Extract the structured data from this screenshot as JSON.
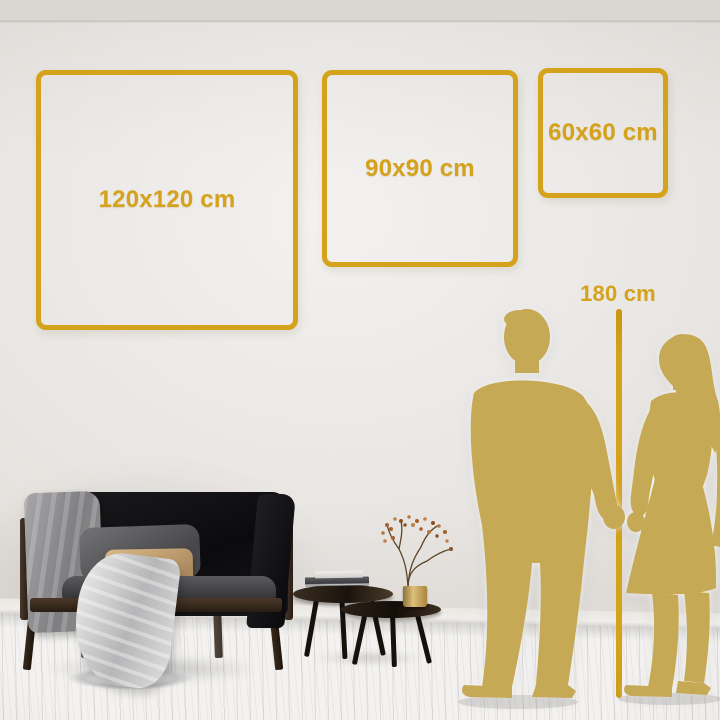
{
  "size_guide": {
    "frames": [
      {
        "id": "frame-120",
        "label": "120x120 cm",
        "width_cm": 120,
        "height_cm": 120
      },
      {
        "id": "frame-90",
        "label": "90x90 cm",
        "width_cm": 90,
        "height_cm": 90
      },
      {
        "id": "frame-60",
        "label": "60x60 cm",
        "width_cm": 60,
        "height_cm": 60
      }
    ],
    "height_reference": {
      "label": "180 cm",
      "height_cm": 180
    }
  },
  "colors": {
    "accent": "#D5A21C",
    "silhouette": "#C6A955",
    "wall": "#E3E0DC",
    "floor": "#F3F2F0"
  },
  "scene_objects": [
    "black-loveseat-sofa",
    "gray-blanket",
    "gray-pillow",
    "tan-lumbar-pillow",
    "white-throw",
    "nesting-coffee-tables",
    "books-stack",
    "brass-vase-with-dried-branches",
    "man-silhouette",
    "woman-silhouette",
    "white-plank-floor"
  ]
}
